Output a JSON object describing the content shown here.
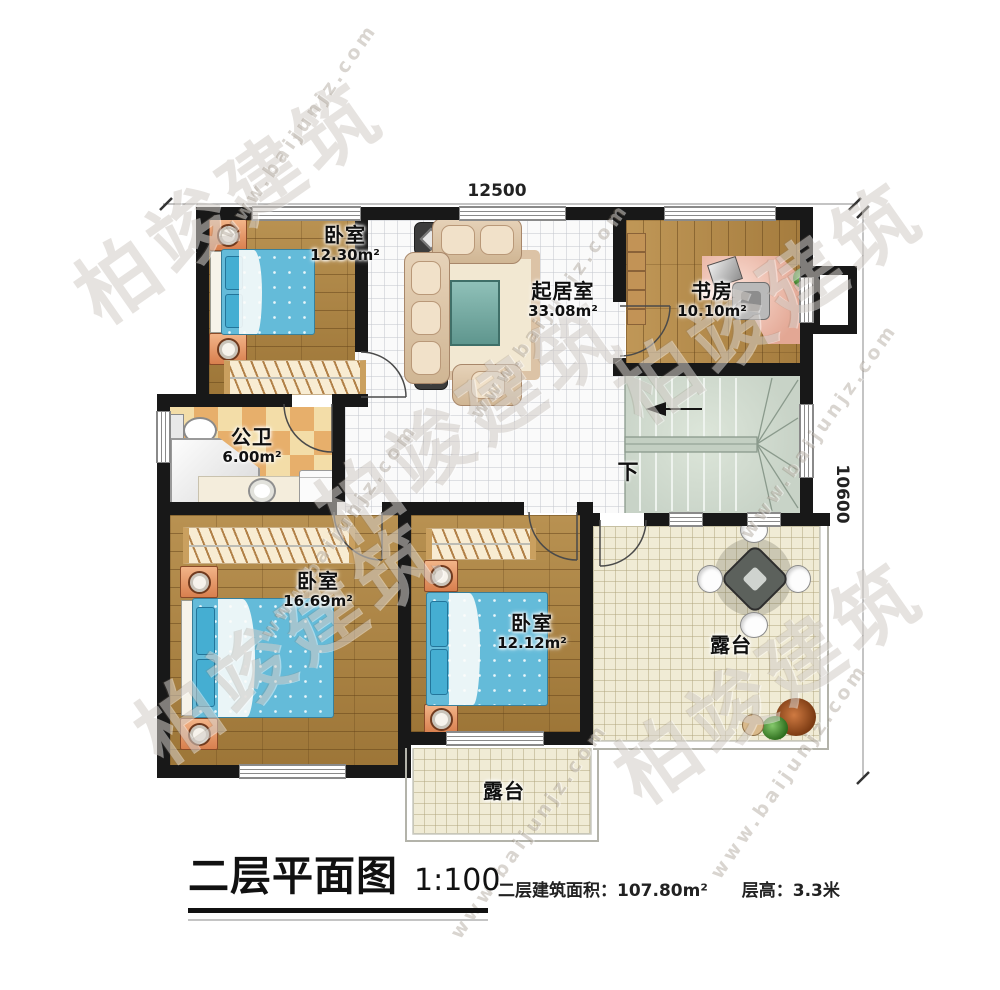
{
  "dimensions": {
    "top": "12500",
    "right": "10600"
  },
  "rooms": {
    "bedroom_top_left": {
      "name": "卧室",
      "area": "12.30m²"
    },
    "living": {
      "name": "起居室",
      "area": "33.08m²"
    },
    "study": {
      "name": "书房",
      "area": "10.10m²"
    },
    "bathroom": {
      "name": "公卫",
      "area": "6.00m²"
    },
    "bedroom_bottom_left": {
      "name": "卧室",
      "area": "16.69m²"
    },
    "bedroom_bottom_center": {
      "name": "卧室",
      "area": "12.12m²"
    },
    "terrace_right": {
      "name": "露台"
    },
    "terrace_bottom": {
      "name": "露台"
    }
  },
  "stairs": {
    "direction_label": "下"
  },
  "title_block": {
    "title": "二层平面图",
    "scale": "1:100",
    "floor_area_label": "二层建筑面积：",
    "floor_area_value": "107.80m²",
    "story_height_label": "层高：",
    "story_height_value": "3.3米"
  },
  "watermark": {
    "brand": "柏竣建筑",
    "website": "www.baijunjz.com"
  },
  "colors": {
    "wall": "#181818",
    "wood_floor": "#a9803e",
    "tile_floor": "#fafafa",
    "bath_tile_light": "#f3dda8",
    "bath_tile_dark": "#e7af6b",
    "terrace_floor": "#f0ebd5",
    "stairs_floor": "#cfd9ce",
    "bed": "#64bbd9",
    "nightstand": "#d87f4e",
    "sofa": "#d9c3ab",
    "desk": "#e8b2a2"
  }
}
